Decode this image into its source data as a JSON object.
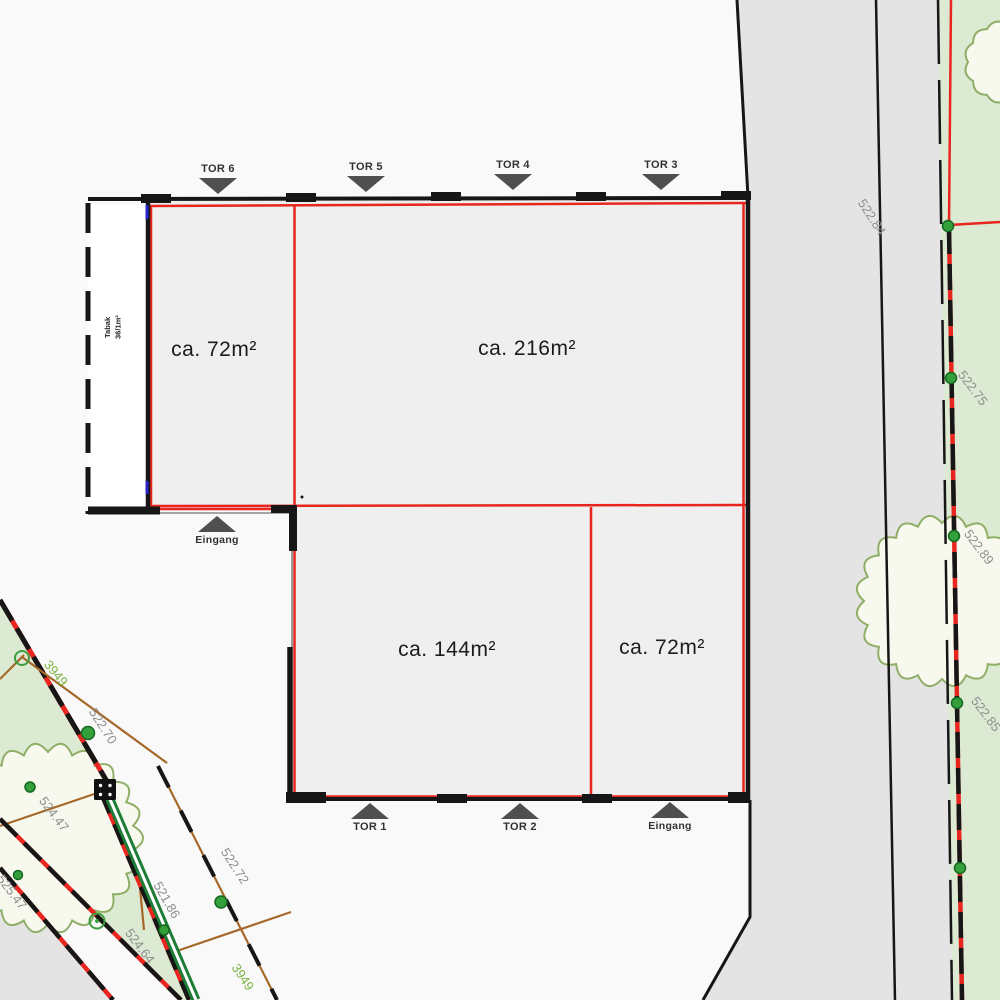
{
  "rooms": {
    "top_left": "ca. 72m²",
    "top_right": "ca. 216m²",
    "bottom_left": "ca. 144m²",
    "bottom_right": "ca. 72m²"
  },
  "side_room": {
    "line1": "Tabak",
    "line2": "36/1m²"
  },
  "gates": {
    "tor6": "TOR 6",
    "tor5": "TOR 5",
    "tor4": "TOR 4",
    "tor3": "TOR 3",
    "tor1": "TOR 1",
    "tor2": "TOR 2"
  },
  "entrances": {
    "left": "Eingang",
    "bottom": "Eingang"
  },
  "elevations": {
    "right_top": "522.84",
    "right_mid1": "522.75",
    "right_mid2": "522.89",
    "right_bottom": "522.85",
    "left_road": "522.70",
    "left_tree": "524.47",
    "left_corner": "525.47",
    "left_low1": "521.86",
    "left_low2": "524.64",
    "left_mid": "522.72"
  },
  "parcels": {
    "upper": "3949",
    "lower": "3949"
  },
  "colors": {
    "red_line": "#e8251f",
    "wall_black": "#161616",
    "street_gray": "#e4e4e4",
    "parcel_green": "#dcead3",
    "tree_fill": "#f7f9ee",
    "tree_stroke": "#8fae67",
    "boundary_brown": "#a5682a",
    "elevation_gray": "#8f8f8f",
    "parcel_label_green": "#7cb342",
    "survey_green": "#1e7d36",
    "gate_gray": "#4f4f4f"
  }
}
